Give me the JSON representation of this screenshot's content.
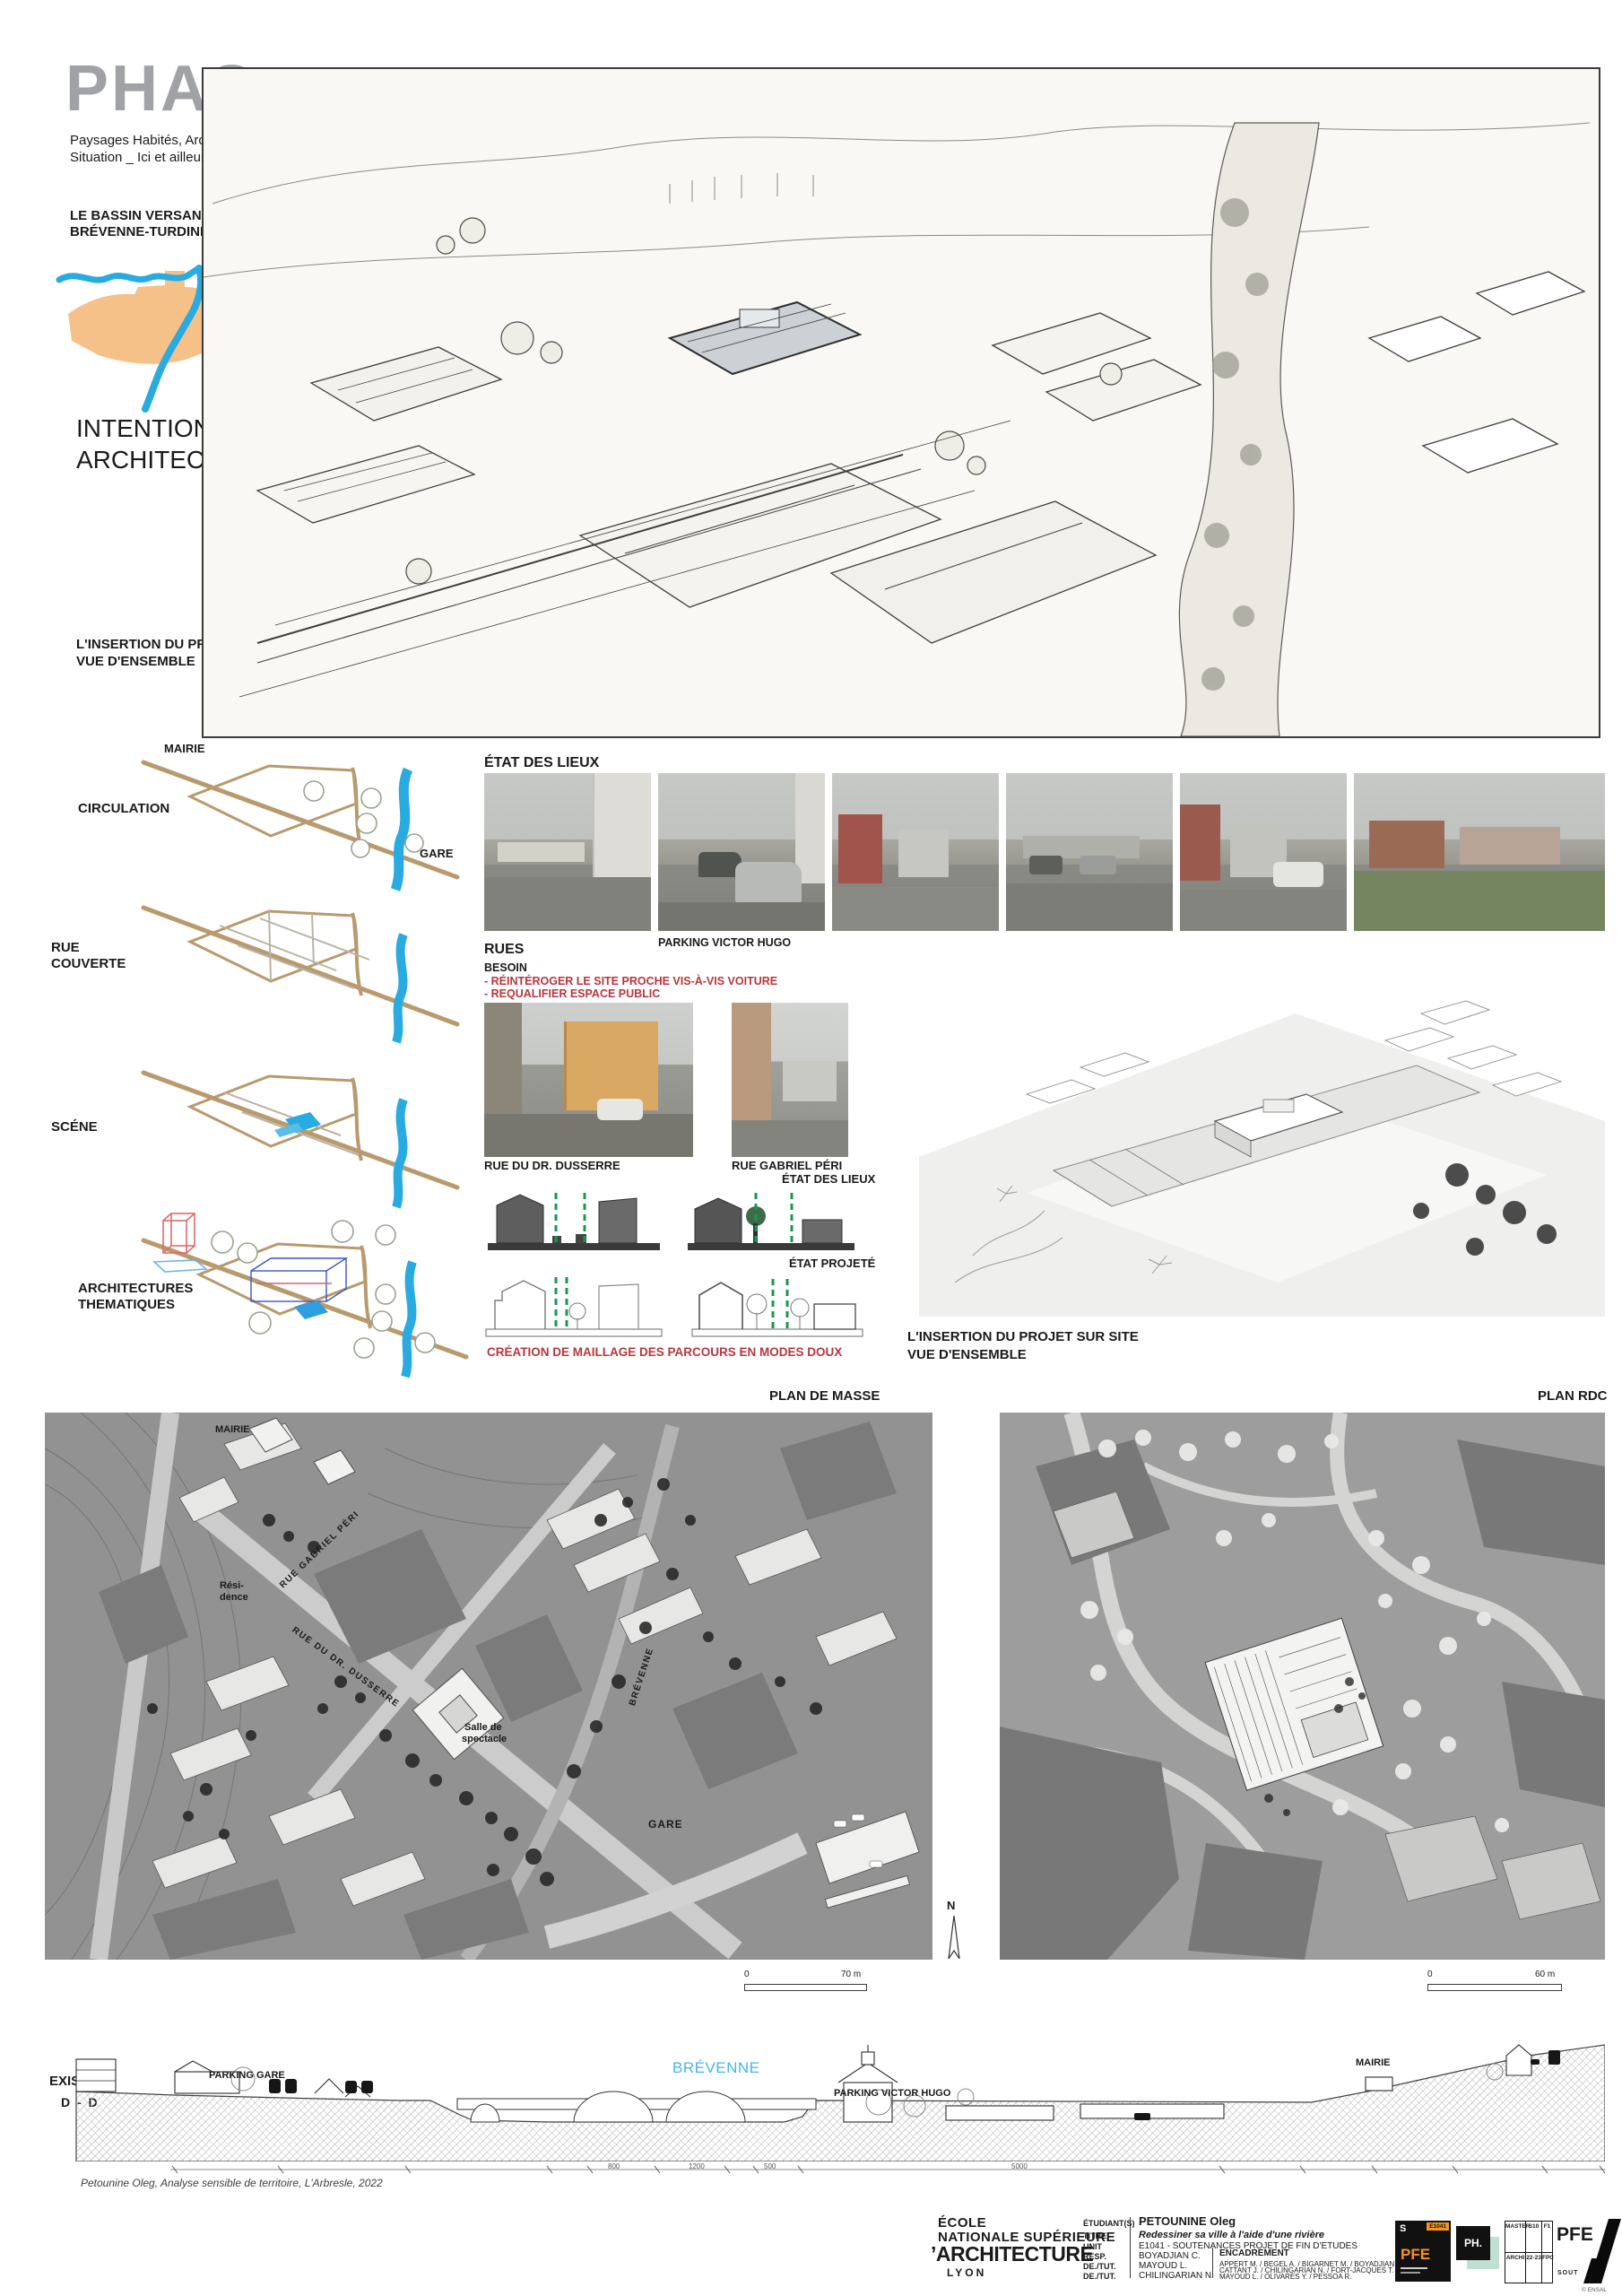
{
  "header": {
    "logo": "PHAS",
    "subtitle_line1": "Paysages Habités, Architectures en",
    "subtitle_line2": "Situation _ Ici et ailleurs en Europe",
    "bassin_line1": "LE BASSIN VERSANT",
    "bassin_line2": "BRÉVENNE-TURDINE",
    "intention_line1": "INTENTION",
    "intention_line2": "ARCHITECTURALE",
    "insertion_line1": "L'INSERTION DU PROJET SUR SITE",
    "insertion_line2": "VUE D'ENSEMBLE"
  },
  "diagrams": {
    "mairie": "MAIRIE",
    "gare": "GARE",
    "circulation": "CIRCULATION",
    "rue_line1": "RUE",
    "rue_line2": "COUVERTE",
    "scene": "SCÉNE",
    "arch_line1": "ARCHITECTURES",
    "arch_line2": "THEMATIQUES"
  },
  "etat": {
    "title": "ÉTAT DES LIEUX",
    "parking_caption": "PARKING VICTOR HUGO",
    "rues": "RUES",
    "besoin": "BESOIN",
    "besoin_item1": "- RÉINTÉROGER LE SITE PROCHE VIS-À-VIS VOITURE",
    "besoin_item2": "- REQUALIFIER ESPACE PUBLIC",
    "dusserre_caption": "RUE DU DR. DUSSERRE",
    "peri_caption": "RUE GABRIEL PÉRI",
    "etat_lieux": "ÉTAT DES LIEUX",
    "etat_projete": "ÉTAT PROJETÉ",
    "creation": "CRÉATION DE MAILLAGE DES PARCOURS EN MODES DOUX"
  },
  "axon": {
    "caption_line1": "L'INSERTION DU PROJET SUR SITE",
    "caption_line2": "VUE D'ENSEMBLE"
  },
  "plans": {
    "left_title": "PLAN DE MASSE",
    "right_title": "PLAN RDC",
    "mairie": "MAIRIE",
    "residence_line1": "Rési-",
    "residence_line2": "dence",
    "rue_gabriel_peri": "RUE GABRIEL PÉRI",
    "rue_dusserre": "RUE DU DR. DUSSERRE",
    "brevenne": "BRÉVENNE",
    "salle_line1": "Salle de",
    "salle_line2": "spectacle",
    "gare": "GARE",
    "north": "N",
    "scale_left_zero": "0",
    "scale_left_max": "70 m",
    "scale_right_zero": "0",
    "scale_right_max": "60 m"
  },
  "section": {
    "existant": "EXISTANT",
    "cut": "D - D",
    "parking_gare": "PARKING GARE",
    "brevenne": "BRÉVENNE",
    "parking_victor_hugo": "PARKING VICTOR HUGO",
    "mairie": "MAIRIE",
    "dims": [
      "800",
      "1200",
      "500",
      "5000"
    ],
    "credit": "Petounine Oleg, Analyse sensible de territoire, L'Arbresle, 2022"
  },
  "footer": {
    "school_line1": "ÉCOLE",
    "school_line2": "NATIONALE SUPÉRIEURE",
    "school_line3": "’ARCHITECTURE",
    "school_line4": "LYON",
    "etudiant_label": "ÉTUDIANT(S)",
    "etudiant": "PETOUNINE Oleg",
    "titre_label": "TITRE",
    "titre": "Redessiner sa ville à l'aide d'une rivière",
    "unit_label": "UNIT",
    "unit": "E1041 - SOUTENANCES PROJET DE FIN D'ETUDES",
    "resp_label": "RESP.",
    "resp": "BOYADJIAN C.",
    "tut1_label": "DE./TUT.",
    "tut1": "MAYOUD L.",
    "tut2_label": "DE./TUT.",
    "tut2": "CHILINGARIAN N.",
    "encadrement_label": "ENCADREMENT",
    "encadrement_line1": "APPERT M. / BEGEL A. / BIGARNET M. / BOYADJIAN C.",
    "encadrement_line2": "CATTANT J. / CHILINGARIAN N. / FORT-JACQUES T.",
    "encadrement_line3": "MAYOUD L. / OLIVARES Y. / PESSOA R.",
    "badge1_s": "S",
    "badge1_code": "E1041",
    "badge1_pfe": "PFE",
    "badge2": "PH.",
    "badge_table": {
      "c1r1": "MASTER",
      "c1r2": "ARCHI",
      "c2r1": "S10",
      "c2r2": "22-23",
      "c3r1": "F1",
      "c3r2": "FPC"
    },
    "pfe_big": "PFE",
    "sout": "SOUT",
    "copyright": "© ENSAL"
  },
  "colors": {
    "logo_gray": "#a0a2a5",
    "river_blue": "#29abe2",
    "basin_orange": "#f6c189",
    "road_tan": "#b89a6c",
    "accent_red": "#b5373c",
    "dash_green": "#15994f"
  }
}
